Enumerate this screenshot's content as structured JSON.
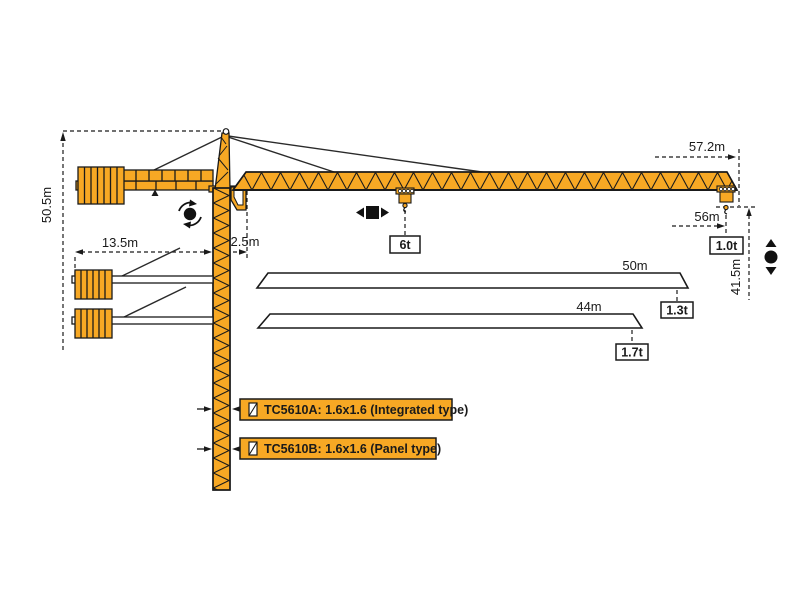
{
  "diagram": {
    "title": "TC5610 tower crane working range diagram",
    "dims": {
      "total_height": "50.5m",
      "counter_jib_radius": "13.5m",
      "jib_root_offset": "2.5m",
      "max_radius": "57.2m",
      "tip_hook_radius": "56m",
      "under_hook_height": "41.5m"
    },
    "loads": {
      "mid_jib": "6t",
      "tip_main_jib": "1.0t",
      "tip_50m_jib": "1.3t",
      "tip_44m_jib": "1.7t"
    },
    "alt_jibs": {
      "jib_50m": "50m",
      "jib_44m": "44m"
    },
    "models": {
      "a": "TC5610A:  1.6x1.6  (Integrated type)",
      "b": "TC5610B:  1.6x1.6  (Panel type)"
    },
    "colors": {
      "crane_orange": "#F7A824",
      "outline": "#1A1A1A",
      "background": "#FFFFFF"
    },
    "icons": {
      "slewing-icon": "dot-with-rotation-arrows",
      "trolley-travel-icon": "square-with-left-right-arrows",
      "hoisting-icon": "dot-with-up-down-arrows",
      "mast-section-icon": "small-square-with-diagonal"
    }
  }
}
